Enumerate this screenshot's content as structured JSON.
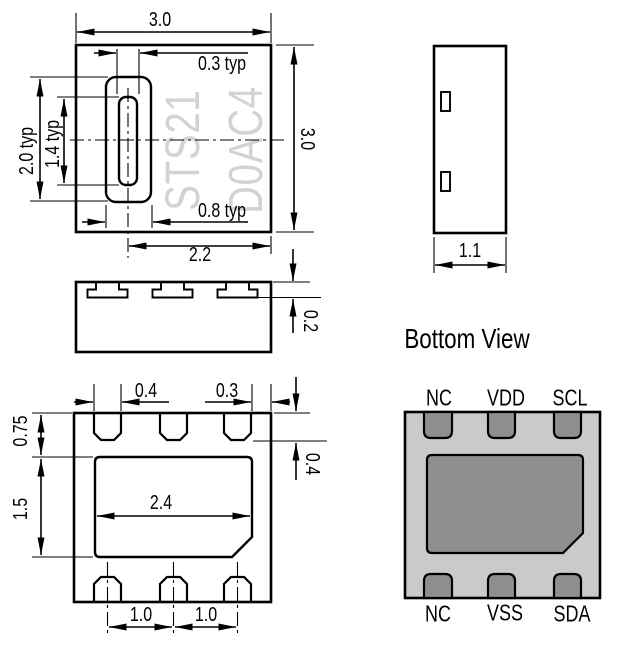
{
  "drawing": {
    "top_view": {
      "marking": [
        "STS21",
        "D0AC4"
      ],
      "dim_width": "3.0",
      "dim_height": "3.0",
      "dim_slot_width": "0.3 typ",
      "dim_slot_outer_height": "2.0 typ",
      "dim_slot_inner_height": "1.4 typ",
      "dim_slot_outer_width": "0.8 typ",
      "dim_center_to_edge": "2.2"
    },
    "side_view": {
      "dim_depth": "1.1"
    },
    "front_view": {
      "dim_pad_thickness": "0.2"
    },
    "bottom_dims": {
      "dim_pad_width": "0.4",
      "dim_edge_gap": "0.3",
      "dim_pad_length": "0.4",
      "dim_row_offset": "0.75",
      "dim_diepad_height": "1.5",
      "dim_diepad_width": "2.4",
      "dim_pitch_left": "1.0",
      "dim_pitch_right": "1.0"
    },
    "pinout": {
      "title": "Bottom View",
      "pins_top": [
        "NC",
        "VDD",
        "SCL"
      ],
      "pins_bottom": [
        "NC",
        "VSS",
        "SDA"
      ],
      "body_color": "#cacaca",
      "pad_color": "#8f8f8f"
    }
  }
}
